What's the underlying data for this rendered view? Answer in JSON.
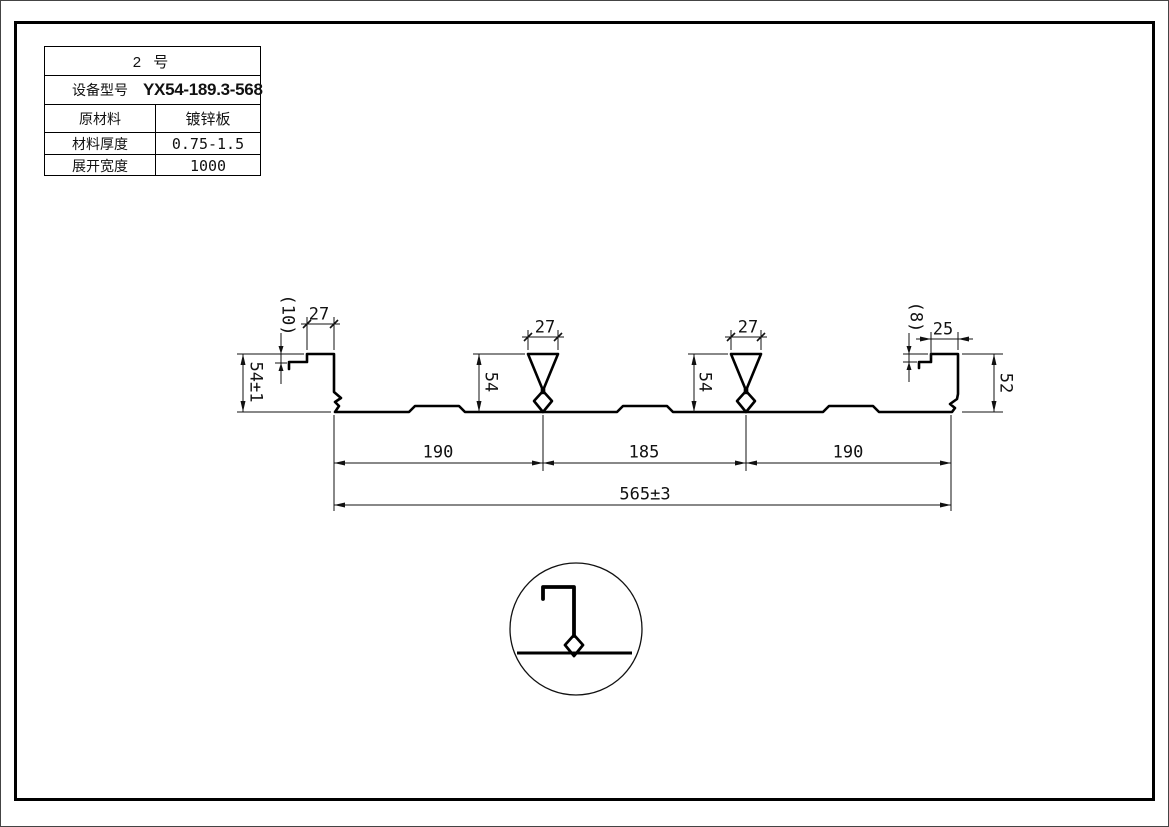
{
  "title_block": {
    "header": "2  号",
    "rows": [
      {
        "label": "设备型号",
        "value": "YX54-189.3-568"
      },
      {
        "label": "原材料",
        "value": "镀锌板"
      },
      {
        "label": "材料厚度",
        "value": "0.75-1.5"
      },
      {
        "label": "展开宽度",
        "value": "1000"
      }
    ]
  },
  "dimensions": {
    "left_lip": "(10)",
    "left_flange": "27",
    "left_height": "54±1",
    "rib1_width": "27",
    "rib1_height": "54",
    "rib2_width": "27",
    "rib2_height": "54",
    "right_lip": "(8)",
    "right_flange": "25",
    "right_height": "52",
    "span_left": "190",
    "span_mid": "185",
    "span_right": "190",
    "overall_width": "565±3"
  },
  "colors": {
    "line": "#000000",
    "dim_line": "#111111",
    "background": "#ffffff"
  }
}
